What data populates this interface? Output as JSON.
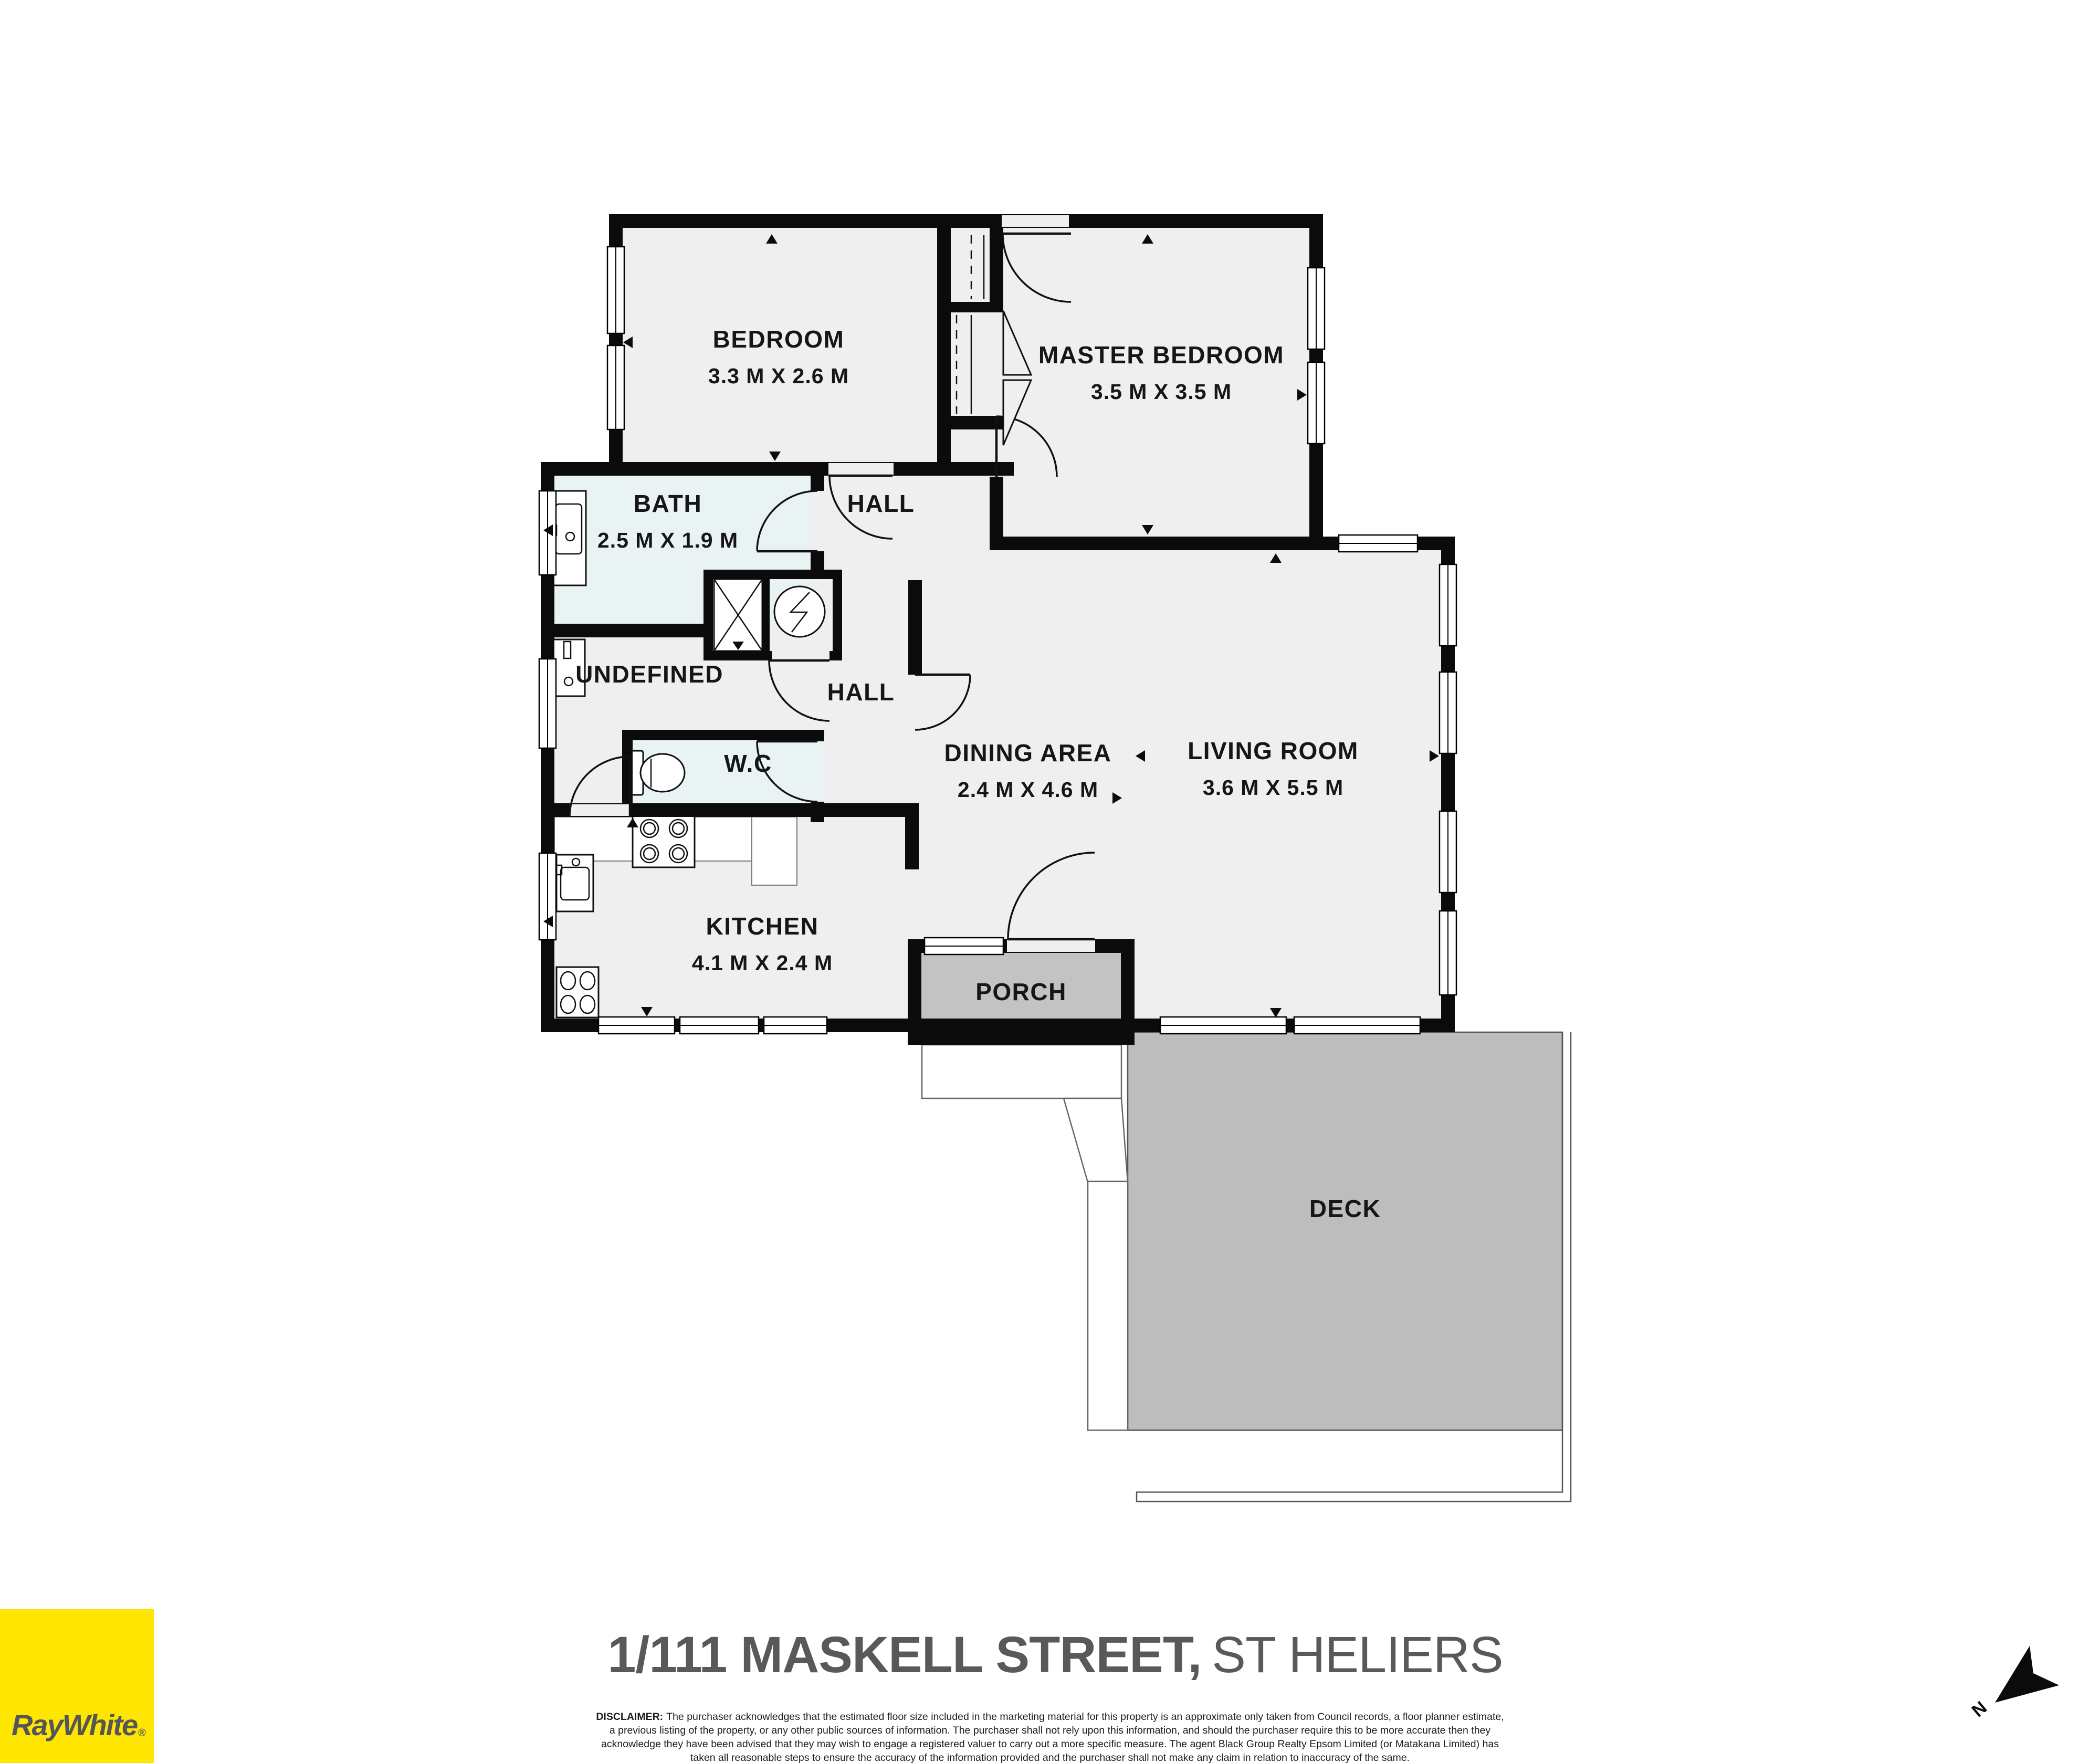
{
  "floorplan": {
    "rooms": [
      {
        "id": "bedroom",
        "name": "BEDROOM",
        "dims": "3.3 M X 2.6 M"
      },
      {
        "id": "master-bedroom",
        "name": "MASTER BEDROOM",
        "dims": "3.5 M X 3.5 M"
      },
      {
        "id": "bath",
        "name": "BATH",
        "dims": "2.5 M X 1.9 M"
      },
      {
        "id": "hall-upper",
        "name": "HALL"
      },
      {
        "id": "undefined-room",
        "name": "UNDEFINED"
      },
      {
        "id": "hall-lower",
        "name": "HALL"
      },
      {
        "id": "wc",
        "name": "W.C"
      },
      {
        "id": "dining-area",
        "name": "DINING AREA",
        "dims": "2.4 M X 4.6 M"
      },
      {
        "id": "living-room",
        "name": "LIVING ROOM",
        "dims": "3.6 M X 5.5 M"
      },
      {
        "id": "kitchen",
        "name": "KITCHEN",
        "dims": "4.1 M X 2.4 M"
      },
      {
        "id": "porch",
        "name": "PORCH"
      },
      {
        "id": "deck",
        "name": "DECK"
      }
    ],
    "compass": {
      "label": "N"
    }
  },
  "footer": {
    "title_bold": "1/111 MASKELL STREET,",
    "title_regular": "ST HELIERS",
    "disclaimer_label": "DISCLAIMER:",
    "disclaimer": [
      "The purchaser acknowledges that the estimated floor size included in the marketing material for this property is an approximate only taken from Council records, a floor planner estimate,",
      "a previous listing of the property, or any other public sources of information.  The purchaser shall not rely upon this information, and should the purchaser require this to be more accurate then they",
      "acknowledge they have been advised that they may wish to engage a registered valuer to carry out a more specific measure.  The agent Black Group Realty Epsom Limited (or Matakana Limited) has",
      "taken all reasonable steps to ensure the accuracy of the information provided and the purchaser shall not make any claim in relation to inaccuracy of the same."
    ]
  },
  "brand": {
    "logo_text": "RayWhite",
    "registered": "®",
    "logo_bg": "#ffe600",
    "logo_fg": "#54565a"
  },
  "colors": {
    "wall": "#0b0b0b",
    "floor": "#efefef",
    "wet_room": "#e9f3f4",
    "porch": "#c3c3c3",
    "deck": "#bdbdbd",
    "title": "#58595b"
  }
}
